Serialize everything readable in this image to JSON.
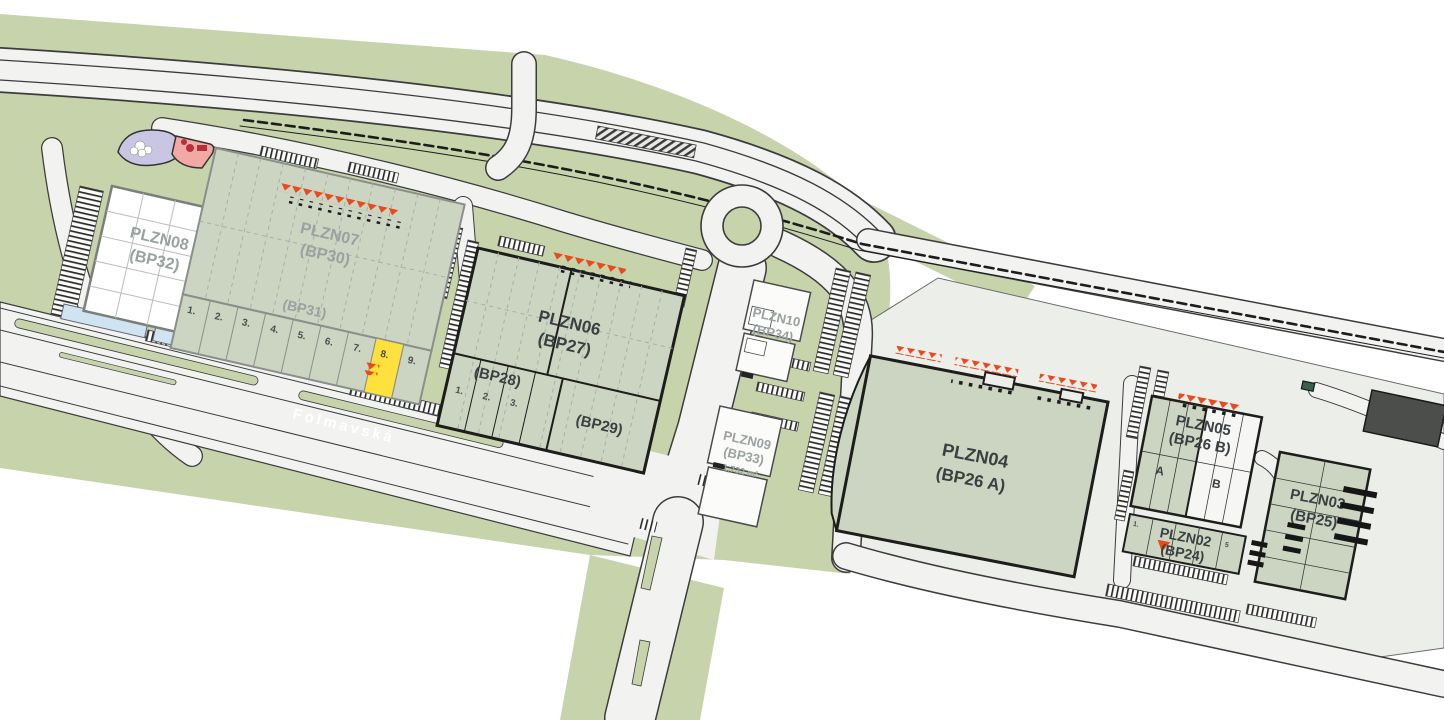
{
  "road": {
    "name": "Folmavská"
  },
  "buildings": {
    "plzn08": {
      "name": "PLZN08",
      "bp": "(BP32)"
    },
    "plzn07": {
      "name": "PLZN07",
      "bp": "(BP30)",
      "bp31": "(BP31)",
      "units": [
        "1.",
        "2.",
        "3.",
        "4.",
        "5.",
        "6.",
        "7.",
        "8.",
        "9."
      ]
    },
    "plzn06": {
      "name": "PLZN06",
      "bp": "(BP27)",
      "bp28": "(BP28)",
      "bp29": "(BP29)",
      "units": [
        "1.",
        "2.",
        "3."
      ]
    },
    "plzn10": {
      "name": "PLZN10",
      "bp": "(BP34)"
    },
    "plzn09": {
      "name": "PLZN09",
      "bp": "(BP33)",
      "area": "1,732 m²"
    },
    "plzn04": {
      "name": "PLZN04",
      "bp": "(BP26 A)"
    },
    "plzn05": {
      "name": "PLZN05",
      "bp": "(BP26 B)",
      "unit_a": "A",
      "unit_b": "B"
    },
    "plzn02": {
      "name": "PLZN02",
      "bp": "(BP24)",
      "unit_first": "1.",
      "unit_last": "5"
    },
    "plzn03": {
      "name": "PLZN03",
      "bp": "(BP25)"
    }
  },
  "colors": {
    "landscape_green": "#c6d3ab",
    "building_green": "#ccd5c2",
    "road_white": "#f2f2f0",
    "plot_gray": "#eceee9",
    "outline_dark": "#1d1d1b",
    "outline_gray": "#7a7f7a",
    "dock_orange": "#e8491d",
    "highlight_yellow": "#ffe13d",
    "label_gray": "#99a1a1",
    "label_dark": "#3a3f41",
    "water_blue": "#cfe3f1",
    "pond_lavender": "#c9c6e3",
    "play_pink": "#f0a9a4",
    "dark_building": "#4c4e4b"
  }
}
